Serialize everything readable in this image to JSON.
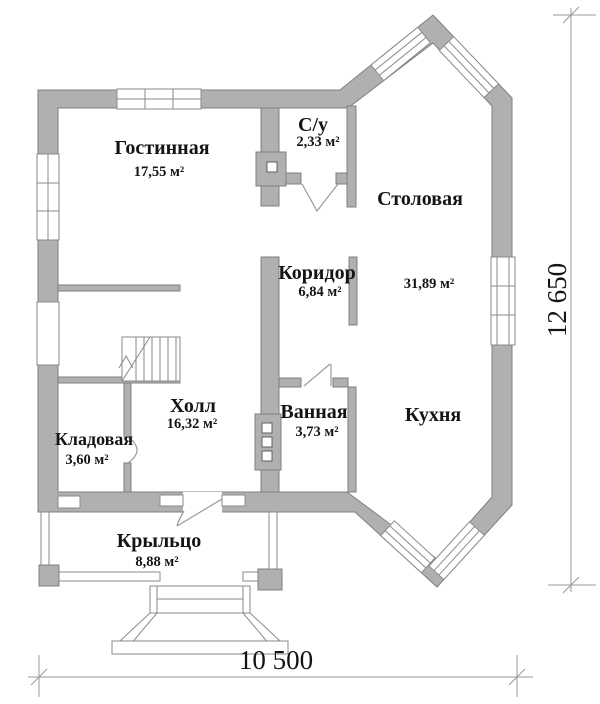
{
  "plan": {
    "rooms": {
      "living": {
        "name": "Гостинная",
        "area": "17,55 м²"
      },
      "wc": {
        "name": "С/у",
        "area": "2,33 м²"
      },
      "dining": {
        "name": "Столовая"
      },
      "dining_kitchen": {
        "area": "31,89 м²"
      },
      "corridor": {
        "name": "Коридор",
        "area": "6,84 м²"
      },
      "hall": {
        "name": "Холл",
        "area": "16,32 м²"
      },
      "bathroom": {
        "name": "Ванная",
        "area": "3,73 м²"
      },
      "kitchen": {
        "name": "Кухня"
      },
      "storage": {
        "name": "Кладовая",
        "area": "3,60 м²"
      },
      "porch": {
        "name": "Крыльцо",
        "area": "8,88 м²"
      }
    },
    "dimensions": {
      "width_bottom": "10 500",
      "height_right": "12 650"
    },
    "colors": {
      "wall_fill": "#b0b0b0",
      "wall_outline": "#7f7f7f",
      "drawing_line": "#8f8f8f",
      "text": "#141414",
      "background": "#ffffff"
    }
  }
}
